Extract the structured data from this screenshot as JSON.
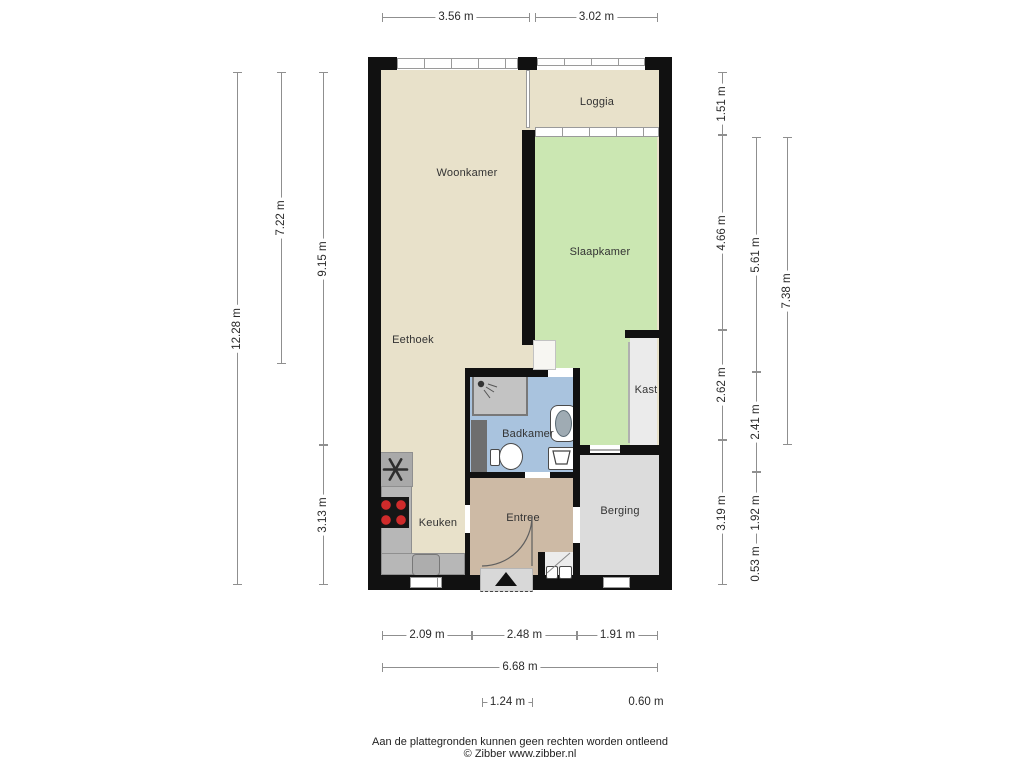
{
  "footer": {
    "line1": "Aan de plattegronden kunnen geen rechten worden ontleend",
    "line2": "© Zibber www.zibber.nl"
  },
  "palette": {
    "wall": "#111111",
    "floor_living": "#e8e1ca",
    "floor_bedroom": "#cbe7b2",
    "floor_bath": "#a9c3de",
    "floor_entry": "#cdbaa5",
    "floor_storage": "#dcdcdc",
    "floor_closet": "#ebebeb",
    "counter": "#b7b7b7",
    "shower": "#c3c3c3",
    "shaft": "#6e6e6e",
    "porch": "#d8d8d8",
    "dim_line": "#8f8f8f",
    "text": "#333333"
  },
  "rooms": [
    {
      "id": "woonkamer",
      "label": "Woonkamer",
      "x": 467,
      "y": 173
    },
    {
      "id": "loggia",
      "label": "Loggia",
      "x": 597,
      "y": 102
    },
    {
      "id": "slaapkamer",
      "label": "Slaapkamer",
      "x": 600,
      "y": 252
    },
    {
      "id": "eethoek",
      "label": "Eethoek",
      "x": 413,
      "y": 340
    },
    {
      "id": "kast",
      "label": "Kast",
      "x": 646,
      "y": 390
    },
    {
      "id": "badkamer",
      "label": "Badkamer",
      "x": 528,
      "y": 434
    },
    {
      "id": "keuken",
      "label": "Keuken",
      "x": 438,
      "y": 523
    },
    {
      "id": "entree",
      "label": "Entree",
      "x": 523,
      "y": 518
    },
    {
      "id": "berging",
      "label": "Berging",
      "x": 620,
      "y": 511
    }
  ],
  "rects": [
    {
      "n": "floor-living",
      "p": "floor_living",
      "x": 381,
      "y": 70,
      "w": 278,
      "h": 505
    },
    {
      "n": "floor-bedroom",
      "p": "floor_bedroom",
      "x": 535,
      "y": 137,
      "w": 122,
      "h": 308
    },
    {
      "n": "floor-closet",
      "p": "floor_closet",
      "x": 630,
      "y": 338,
      "w": 27,
      "h": 107
    },
    {
      "n": "floor-bathroom",
      "p": "floor_bath",
      "x": 470,
      "y": 377,
      "w": 107,
      "h": 95
    },
    {
      "n": "floor-entry",
      "p": "floor_entry",
      "x": 470,
      "y": 478,
      "w": 103,
      "h": 97
    },
    {
      "n": "floor-storage",
      "p": "floor_storage",
      "x": 580,
      "y": 455,
      "w": 79,
      "h": 120
    },
    {
      "n": "kitchen-counter",
      "c": "counter",
      "p": "counter",
      "x": 381,
      "y": 452,
      "w": 31,
      "h": 123
    },
    {
      "n": "kitchen-counter",
      "c": "counter",
      "p": "counter",
      "x": 381,
      "y": 553,
      "w": 84,
      "h": 22
    },
    {
      "n": "extractor-unit",
      "c": "counter",
      "bg": "#a9a9a9",
      "x": 378,
      "y": 452,
      "w": 35,
      "h": 35
    },
    {
      "n": "cooktop",
      "bg": "#161616",
      "x": 378,
      "y": 497,
      "w": 31,
      "h": 31
    },
    {
      "n": "kitchen-sink",
      "c": "sink",
      "bg": "#adadad",
      "x": 412,
      "y": 554,
      "w": 28,
      "h": 22
    },
    {
      "n": "shower",
      "c": "shower",
      "p": "shower",
      "x": 472,
      "y": 374,
      "w": 56,
      "h": 42
    },
    {
      "n": "shaft",
      "p": "shaft",
      "x": 471,
      "y": 420,
      "w": 16,
      "h": 52
    },
    {
      "n": "washbasin",
      "c": "basin",
      "x": 550,
      "y": 405,
      "w": 27,
      "h": 37
    },
    {
      "n": "washbasin-bowl",
      "c": "bowlinner",
      "x": 555,
      "y": 410,
      "w": 17,
      "h": 27
    },
    {
      "n": "toilet-tank",
      "c": "fixture",
      "x": 490,
      "y": 449,
      "w": 10,
      "h": 17
    },
    {
      "n": "toilet-bowl",
      "c": "toilet",
      "x": 499,
      "y": 443,
      "w": 24,
      "h": 27
    },
    {
      "n": "laundry-unit",
      "c": "fixture",
      "x": 548,
      "y": 447,
      "w": 27,
      "h": 23
    },
    {
      "n": "wall",
      "p": "wall",
      "x": 368,
      "y": 57,
      "w": 13,
      "h": 533
    },
    {
      "n": "wall",
      "p": "wall",
      "x": 659,
      "y": 57,
      "w": 13,
      "h": 533
    },
    {
      "n": "wall",
      "p": "wall",
      "x": 368,
      "y": 57,
      "w": 29,
      "h": 13
    },
    {
      "n": "wall",
      "p": "wall",
      "x": 518,
      "y": 57,
      "w": 19,
      "h": 13
    },
    {
      "n": "wall",
      "p": "wall",
      "x": 645,
      "y": 57,
      "w": 27,
      "h": 13
    },
    {
      "n": "wall",
      "p": "wall",
      "x": 368,
      "y": 575,
      "w": 304,
      "h": 15
    },
    {
      "n": "wall",
      "p": "wall",
      "x": 522,
      "y": 130,
      "w": 13,
      "h": 215
    },
    {
      "n": "wall",
      "p": "wall",
      "x": 465,
      "y": 368,
      "w": 115,
      "h": 9
    },
    {
      "n": "wall",
      "p": "wall",
      "x": 465,
      "y": 368,
      "w": 5,
      "h": 207
    },
    {
      "n": "wall",
      "p": "wall",
      "x": 465,
      "y": 472,
      "w": 115,
      "h": 6
    },
    {
      "n": "wall",
      "p": "wall",
      "x": 573,
      "y": 368,
      "w": 7,
      "h": 207
    },
    {
      "n": "wall",
      "p": "wall",
      "x": 573,
      "y": 445,
      "w": 86,
      "h": 10
    },
    {
      "n": "wall",
      "p": "wall",
      "x": 625,
      "y": 330,
      "w": 34,
      "h": 8
    },
    {
      "n": "wall",
      "p": "wall",
      "x": 538,
      "y": 552,
      "w": 7,
      "h": 23
    },
    {
      "n": "window-livingroom",
      "c": "window",
      "x": 397,
      "y": 58,
      "w": 121,
      "h": 11
    },
    {
      "n": "loggia-railing",
      "c": "window",
      "x": 537,
      "y": 58,
      "w": 108,
      "h": 8
    },
    {
      "n": "window-loggia",
      "c": "window",
      "x": 535,
      "y": 127,
      "w": 124,
      "h": 10
    },
    {
      "n": "glass-partition",
      "c": "windowv",
      "x": 526,
      "y": 70,
      "w": 4,
      "h": 58
    },
    {
      "n": "window-kitchen",
      "c": "window",
      "x": 410,
      "y": 577,
      "w": 32,
      "h": 11
    },
    {
      "n": "window-storage",
      "c": "window",
      "x": 603,
      "y": 577,
      "w": 27,
      "h": 11
    },
    {
      "n": "door-opening",
      "c": "gap",
      "x": 465,
      "y": 505,
      "w": 5,
      "h": 28
    },
    {
      "n": "door-opening",
      "c": "gap",
      "x": 525,
      "y": 472,
      "w": 25,
      "h": 6
    },
    {
      "n": "door-opening",
      "c": "gap",
      "x": 548,
      "y": 368,
      "w": 25,
      "h": 9
    },
    {
      "n": "door-opening",
      "c": "doorway",
      "x": 533,
      "y": 340,
      "w": 23,
      "h": 30
    },
    {
      "n": "door-opening",
      "c": "gap",
      "x": 573,
      "y": 507,
      "w": 7,
      "h": 36
    },
    {
      "n": "door-opening",
      "c": "gap",
      "x": 590,
      "y": 445,
      "w": 30,
      "h": 8
    },
    {
      "n": "threshold-line",
      "bg": "#aaaaaa",
      "x": 590,
      "y": 449,
      "w": 30,
      "h": 2
    },
    {
      "n": "closet-slide-door",
      "bg": "#b0b0b0",
      "x": 628,
      "y": 342,
      "w": 2,
      "h": 101
    },
    {
      "n": "floor-niche",
      "bg": "#ececec",
      "x": 545,
      "y": 552,
      "w": 28,
      "h": 23
    },
    {
      "n": "meter-unit",
      "c": "fixture",
      "x": 546,
      "y": 566,
      "w": 12,
      "h": 13
    },
    {
      "n": "meter-unit",
      "c": "fixture",
      "x": 559,
      "y": 566,
      "w": 13,
      "h": 13
    },
    {
      "n": "porch",
      "c": "porch",
      "p": "porch",
      "x": 480,
      "y": 568,
      "w": 53,
      "h": 24
    }
  ],
  "dimensions": [
    {
      "text": "3.56 m",
      "o": "h",
      "x": 382,
      "y": 17,
      "len": 148
    },
    {
      "text": "3.02 m",
      "o": "h",
      "x": 535,
      "y": 17,
      "len": 123
    },
    {
      "text": "2.09 m",
      "o": "h",
      "x": 382,
      "y": 635,
      "len": 90
    },
    {
      "text": "2.48 m",
      "o": "h",
      "x": 472,
      "y": 635,
      "len": 105
    },
    {
      "text": "1.91 m",
      "o": "h",
      "x": 577,
      "y": 635,
      "len": 81
    },
    {
      "text": "6.68 m",
      "o": "h",
      "x": 382,
      "y": 667,
      "len": 276
    },
    {
      "text": "1.24 m",
      "o": "h",
      "x": 482,
      "y": 702,
      "len": 51
    },
    {
      "text": "0.60 m",
      "o": "label",
      "x": 646,
      "y": 702
    },
    {
      "text": "12.28 m",
      "o": "v",
      "x": 237,
      "y": 72,
      "len": 513
    },
    {
      "text": "7.22 m",
      "o": "v",
      "x": 281,
      "y": 72,
      "len": 292
    },
    {
      "text": "9.15 m",
      "o": "v",
      "x": 323,
      "y": 72,
      "len": 373
    },
    {
      "text": "3.13 m",
      "o": "v",
      "x": 323,
      "y": 445,
      "len": 140
    },
    {
      "text": "1.51 m",
      "o": "v",
      "x": 722,
      "y": 72,
      "len": 63
    },
    {
      "text": "4.66 m",
      "o": "v",
      "x": 722,
      "y": 135,
      "len": 195
    },
    {
      "text": "2.62 m",
      "o": "v",
      "x": 722,
      "y": 330,
      "len": 110
    },
    {
      "text": "3.19 m",
      "o": "v",
      "x": 722,
      "y": 440,
      "len": 145
    },
    {
      "text": "5.61 m",
      "o": "v",
      "x": 756,
      "y": 137,
      "len": 235
    },
    {
      "text": "2.41 m",
      "o": "v",
      "x": 756,
      "y": 372,
      "len": 100
    },
    {
      "text": "1.92 m",
      "o": "v",
      "x": 756,
      "y": 472,
      "len": 81
    },
    {
      "text": "0.53 m",
      "o": "v",
      "x": 756,
      "y": 553,
      "len": 22
    },
    {
      "text": "7.38 m",
      "o": "v",
      "x": 787,
      "y": 137,
      "len": 308
    }
  ]
}
